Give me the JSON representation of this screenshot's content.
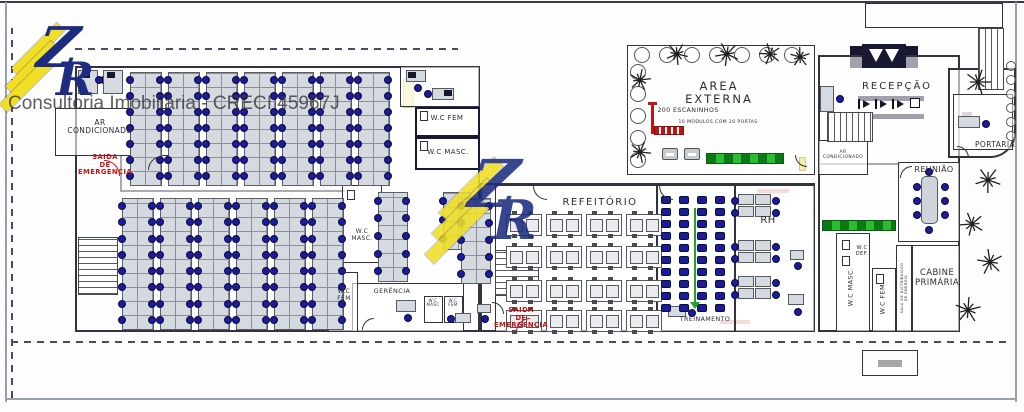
{
  "watermark": {
    "brand_text": "Consultoria Imobiliária - CRECI 45967J",
    "logo_z": "Z",
    "logo_r": "R",
    "accent_yellow": "#f0df25",
    "accent_navy": "#1d2c80"
  },
  "palette": {
    "wall": "#2e2e38",
    "desk": "#d5d9e0",
    "chair_blue": "#1b1b9e",
    "alert_red": "#c21414",
    "locker_green": "#2dbb35",
    "hatch_yellow": "#e8d22a"
  },
  "plan": {
    "labels": [
      {
        "id": "label-ar-condicionado",
        "t": "AR\nCONDICIONADO",
        "x": 100,
        "y": 119,
        "s": 7.5
      },
      {
        "id": "label-saida-emergencia-1",
        "t": "SAIDA\nDE\nEMERGENCIA",
        "x": 105,
        "y": 154,
        "s": 6.8,
        "c": "red"
      },
      {
        "id": "label-wc-fem-upper",
        "t": "W.C FEM",
        "x": 447,
        "y": 115,
        "s": 7
      },
      {
        "id": "label-wc-masc-upper",
        "t": "W.C MASC.",
        "x": 448,
        "y": 149,
        "s": 7
      },
      {
        "id": "label-area-externa",
        "t": "AREA\nEXTERNA",
        "x": 719,
        "y": 80,
        "s": 11.5,
        "ls": 2
      },
      {
        "id": "label-escaninhos",
        "t": "200 ESCANINHOS",
        "x": 688,
        "y": 107,
        "s": 6.3
      },
      {
        "id": "label-modulos",
        "t": "10 MODULOS COM 20 PORTAS",
        "x": 718,
        "y": 120,
        "s": 4.6
      },
      {
        "id": "label-recepcao",
        "t": "RECEPÇÃO",
        "x": 897,
        "y": 81,
        "s": 10,
        "ls": 2
      },
      {
        "id": "label-portaria",
        "t": "PORTARIA",
        "x": 995,
        "y": 141,
        "s": 7.5
      },
      {
        "id": "label-ar-cond-small",
        "t": "AR\nCONDICIONADO",
        "x": 843,
        "y": 151,
        "s": 4.4
      },
      {
        "id": "label-reuniao",
        "t": "REUNIÃO",
        "x": 934,
        "y": 166,
        "s": 8
      },
      {
        "id": "label-rh",
        "t": "RH",
        "x": 768,
        "y": 215,
        "s": 10
      },
      {
        "id": "label-cabine-primaria",
        "t": "CABINE\nPRIMÁRIA",
        "x": 937,
        "y": 269,
        "s": 8.5
      },
      {
        "id": "label-refeitorio",
        "t": "REFEITÓRIO",
        "x": 600,
        "y": 197,
        "s": 10,
        "ls": 1.5
      },
      {
        "id": "label-treinamento",
        "t": "TREINAMENTO",
        "x": 705,
        "y": 316,
        "s": 6.3
      },
      {
        "id": "label-gerencia",
        "t": "GERÊNCIA",
        "x": 392,
        "y": 288,
        "s": 6.5
      },
      {
        "id": "label-wc-masc-mid",
        "t": "W.C\nMASC.",
        "x": 362,
        "y": 229,
        "s": 6
      },
      {
        "id": "label-wc-fem-mid",
        "t": "W.C\nFEM",
        "x": 344,
        "y": 289,
        "s": 6
      },
      {
        "id": "label-wc-small-masc",
        "t": "W.C\nMASC",
        "x": 433,
        "y": 299,
        "s": 4
      },
      {
        "id": "label-wc-small-fem",
        "t": "W.C\nFEM",
        "x": 453,
        "y": 299,
        "s": 4
      },
      {
        "id": "label-wc-masc-right",
        "t": "W.C MASC.",
        "x": 851,
        "y": 287,
        "s": 6.5,
        "r": -90
      },
      {
        "id": "label-wc-fem-right",
        "t": "W.C FEM.",
        "x": 883,
        "y": 298,
        "s": 6.5,
        "r": -90
      },
      {
        "id": "label-wc-def",
        "t": "W.C\nDEF.",
        "x": 862,
        "y": 246,
        "s": 5.2
      },
      {
        "id": "label-sala-energia",
        "t": "SALA DE DISTRIBUIÇÃO\nDE ENERGIA",
        "x": 904,
        "y": 288,
        "s": 3.6,
        "r": -90
      },
      {
        "id": "label-saida-emergencia-2",
        "t": "SAIDA\nDE\nEMERGENCIA",
        "x": 521,
        "y": 307,
        "s": 6.8,
        "c": "red"
      }
    ],
    "rooms": [
      {
        "id": "left-block",
        "x": 75,
        "y": 66,
        "w": 405,
        "h": 266,
        "b": 2
      },
      {
        "id": "mid-block",
        "x": 480,
        "y": 183,
        "w": 335,
        "h": 149,
        "b": 2
      },
      {
        "id": "right-block",
        "x": 818,
        "y": 55,
        "w": 142,
        "h": 277,
        "b": 2
      },
      {
        "id": "area-externa",
        "x": 627,
        "y": 45,
        "w": 188,
        "h": 130,
        "b": 1.5
      },
      {
        "id": "portaria-outer",
        "x": 948,
        "y": 68,
        "w": 68,
        "h": 90,
        "b": 2,
        "rad": "0 0 26px 0"
      },
      {
        "id": "entry-canopy",
        "x": 865,
        "y": 3,
        "w": 138,
        "h": 25,
        "b": 1.5
      },
      {
        "id": "ar-condicionado",
        "x": 55,
        "y": 108,
        "w": 118,
        "h": 48,
        "b": 1.5
      },
      {
        "id": "upper-small-office",
        "x": 400,
        "y": 66,
        "w": 80,
        "h": 41,
        "b": 1.5
      },
      {
        "id": "wc-fem-upper",
        "x": 415,
        "y": 107,
        "w": 65,
        "h": 30,
        "b": 2.5,
        "c": "#181838"
      },
      {
        "id": "wc-masc-upper",
        "x": 415,
        "y": 137,
        "w": 65,
        "h": 33,
        "b": 2.5,
        "c": "#181838"
      },
      {
        "id": "wc-masc-mid",
        "x": 342,
        "y": 185,
        "w": 40,
        "h": 78,
        "b": 1.5
      },
      {
        "id": "gerencia",
        "x": 352,
        "y": 283,
        "w": 112,
        "h": 49,
        "b": 1.5
      },
      {
        "id": "wc-fem-mid",
        "x": 328,
        "y": 272,
        "w": 30,
        "h": 60,
        "b": 1.5
      },
      {
        "id": "wc-small-masc",
        "x": 424,
        "y": 296,
        "w": 19,
        "h": 27,
        "b": 1.2
      },
      {
        "id": "wc-small-fem",
        "x": 444,
        "y": 296,
        "w": 19,
        "h": 27,
        "b": 1.2
      },
      {
        "id": "refeitorio",
        "x": 495,
        "y": 185,
        "w": 162,
        "h": 147,
        "b": 1.5
      },
      {
        "id": "treinamento",
        "x": 657,
        "y": 185,
        "w": 78,
        "h": 147,
        "b": 1.5
      },
      {
        "id": "rh",
        "x": 735,
        "y": 185,
        "w": 80,
        "h": 147,
        "b": 1.5
      },
      {
        "id": "wc-masc-right",
        "x": 836,
        "y": 233,
        "w": 34,
        "h": 99,
        "b": 1.5
      },
      {
        "id": "wc-fem-right",
        "x": 872,
        "y": 268,
        "w": 24,
        "h": 64,
        "b": 1.5
      },
      {
        "id": "sala-energia",
        "x": 896,
        "y": 245,
        "w": 16,
        "h": 87,
        "b": 1.5
      },
      {
        "id": "cabine-primaria",
        "x": 912,
        "y": 245,
        "w": 48,
        "h": 87,
        "b": 1.5
      },
      {
        "id": "reuniao",
        "x": 898,
        "y": 162,
        "w": 62,
        "h": 80,
        "b": 1.5
      },
      {
        "id": "ar-cond-small",
        "x": 818,
        "y": 140,
        "w": 50,
        "h": 35,
        "b": 1.5
      },
      {
        "id": "portaria-room",
        "x": 953,
        "y": 94,
        "w": 60,
        "h": 56,
        "b": 1.5
      },
      {
        "id": "equipment-box",
        "x": 862,
        "y": 350,
        "w": 56,
        "h": 26,
        "b": 1.5
      },
      {
        "id": "wc-fixture",
        "x": 420,
        "y": 111,
        "w": 8,
        "h": 10,
        "b": 1
      },
      {
        "id": "wc-fixture",
        "x": 420,
        "y": 141,
        "w": 8,
        "h": 10,
        "b": 1
      },
      {
        "id": "wc-fixture",
        "x": 842,
        "y": 240,
        "w": 8,
        "h": 10,
        "b": 1
      },
      {
        "id": "wc-fixture",
        "x": 842,
        "y": 256,
        "w": 8,
        "h": 10,
        "b": 1
      },
      {
        "id": "wc-fixture",
        "x": 876,
        "y": 274,
        "w": 8,
        "h": 10,
        "b": 1
      },
      {
        "id": "wc-fixture",
        "x": 331,
        "y": 280,
        "w": 8,
        "h": 10,
        "b": 1
      },
      {
        "id": "wc-fixture",
        "x": 347,
        "y": 190,
        "w": 8,
        "h": 10,
        "b": 1
      }
    ],
    "walls": [
      {
        "x": 120,
        "y": 190,
        "w": 225,
        "h": 2
      },
      {
        "x": 120,
        "y": 156,
        "w": 2,
        "h": 36
      },
      {
        "x": 342,
        "y": 263,
        "w": 2,
        "h": 22
      },
      {
        "x": 818,
        "y": 163,
        "w": 82,
        "h": 2
      }
    ],
    "frame_bars": [
      {
        "x": 0,
        "y": 1,
        "w": 1024,
        "h": 2,
        "c": "#3c3c46"
      },
      {
        "x": 5,
        "y": 2,
        "w": 2,
        "h": 400,
        "c": "#9aa0a8"
      },
      {
        "x": 1015,
        "y": 2,
        "w": 2,
        "h": 400,
        "c": "#9aa0a8"
      },
      {
        "x": 5,
        "y": 398,
        "w": 1012,
        "h": 2,
        "c": "#9aa0a8"
      }
    ],
    "bars": [
      {
        "x": 858,
        "y": 96,
        "w": 66,
        "h": 5,
        "c": "#16162e"
      },
      {
        "x": 858,
        "y": 114,
        "w": 66,
        "h": 5,
        "c": "#16162e"
      },
      {
        "x": 850,
        "y": 46,
        "w": 12,
        "h": 22,
        "c": "#16162e"
      },
      {
        "x": 906,
        "y": 46,
        "w": 12,
        "h": 22,
        "c": "#16162e"
      },
      {
        "x": 757,
        "y": 189,
        "w": 32,
        "h": 4,
        "c": "#cc1414"
      },
      {
        "x": 720,
        "y": 320,
        "w": 30,
        "h": 4,
        "c": "#cc1414"
      },
      {
        "x": 403,
        "y": 78,
        "w": 11,
        "h": 30,
        "c": "#e8d22a",
        "bd": "#8a7a10"
      },
      {
        "x": 799,
        "y": 157,
        "w": 7,
        "h": 14,
        "c": "#e8d22a",
        "bd": "#8a7a10"
      },
      {
        "x": 822,
        "y": 90,
        "w": 9,
        "h": 7,
        "c": "#16162e"
      },
      {
        "x": 962,
        "y": 112,
        "w": 10,
        "h": 8,
        "c": "#16162e"
      },
      {
        "x": 480,
        "y": 306,
        "w": 8,
        "h": 7,
        "c": "#16162e"
      },
      {
        "x": 878,
        "y": 360,
        "w": 24,
        "h": 7,
        "c": "#222222"
      }
    ],
    "dashes": [
      {
        "x": 75,
        "y": 48,
        "w": 383,
        "h": 0
      },
      {
        "x": 11,
        "y": 28,
        "w": 0,
        "h": 370
      },
      {
        "x": 11,
        "y": 341,
        "w": 1001,
        "h": 0
      }
    ],
    "stairs": [
      {
        "x": 78,
        "y": 237,
        "w": 40,
        "h": 58,
        "d": "h"
      },
      {
        "x": 495,
        "y": 250,
        "w": 44,
        "h": 46,
        "d": "h"
      },
      {
        "x": 827,
        "y": 112,
        "w": 46,
        "h": 30,
        "d": "v"
      },
      {
        "x": 978,
        "y": 28,
        "w": 26,
        "h": 62,
        "d": "v"
      }
    ],
    "office_strips": [
      {
        "x": 130,
        "y": 72,
        "w": 30,
        "h": 112,
        "r": 7
      },
      {
        "x": 168,
        "y": 72,
        "w": 30,
        "h": 112,
        "r": 7
      },
      {
        "x": 206,
        "y": 72,
        "w": 30,
        "h": 112,
        "r": 7
      },
      {
        "x": 244,
        "y": 72,
        "w": 30,
        "h": 112,
        "r": 7
      },
      {
        "x": 282,
        "y": 72,
        "w": 30,
        "h": 112,
        "r": 7
      },
      {
        "x": 320,
        "y": 72,
        "w": 30,
        "h": 112,
        "r": 7
      },
      {
        "x": 358,
        "y": 72,
        "w": 30,
        "h": 112,
        "r": 7
      },
      {
        "x": 122,
        "y": 198,
        "w": 30,
        "h": 130,
        "r": 8
      },
      {
        "x": 160,
        "y": 198,
        "w": 30,
        "h": 130,
        "r": 8
      },
      {
        "x": 198,
        "y": 198,
        "w": 30,
        "h": 130,
        "r": 8
      },
      {
        "x": 236,
        "y": 198,
        "w": 30,
        "h": 130,
        "r": 8
      },
      {
        "x": 274,
        "y": 198,
        "w": 30,
        "h": 130,
        "r": 8
      },
      {
        "x": 312,
        "y": 198,
        "w": 30,
        "h": 130,
        "r": 8
      },
      {
        "x": 378,
        "y": 192,
        "w": 28,
        "h": 88,
        "r": 5
      },
      {
        "x": 443,
        "y": 192,
        "w": 26,
        "h": 56,
        "r": 3
      },
      {
        "x": 461,
        "y": 198,
        "w": 28,
        "h": 84,
        "r": 5
      }
    ],
    "desks": [
      {
        "x": 78,
        "y": 70,
        "w": 20,
        "h": 24,
        "dots": [
          [
            22,
            6
          ]
        ],
        "mon": [
          4,
          2
        ]
      },
      {
        "x": 103,
        "y": 70,
        "w": 20,
        "h": 24,
        "dots": [
          [
            -8,
            6
          ]
        ],
        "mon": [
          4,
          2
        ]
      },
      {
        "x": 406,
        "y": 70,
        "w": 20,
        "h": 12,
        "dots": [
          [
            8,
            14
          ]
        ],
        "mon": [
          2,
          2
        ]
      },
      {
        "x": 432,
        "y": 88,
        "w": 22,
        "h": 12,
        "dots": [
          [
            -8,
            2
          ]
        ],
        "mon": [
          12,
          2
        ]
      },
      {
        "x": 820,
        "y": 86,
        "w": 14,
        "h": 26,
        "dots": [
          [
            16,
            9
          ]
        ]
      },
      {
        "x": 958,
        "y": 116,
        "w": 22,
        "h": 12,
        "dots": [
          [
            24,
            4
          ]
        ]
      },
      {
        "x": 668,
        "y": 306,
        "w": 18,
        "h": 11,
        "dots": [
          [
            20,
            3
          ]
        ]
      },
      {
        "x": 790,
        "y": 250,
        "w": 14,
        "h": 10,
        "dots": [
          [
            4,
            12
          ]
        ]
      },
      {
        "x": 788,
        "y": 294,
        "w": 16,
        "h": 11,
        "dots": [
          [
            6,
            14
          ]
        ]
      },
      {
        "x": 396,
        "y": 300,
        "w": 20,
        "h": 12,
        "dots": [
          [
            8,
            14
          ]
        ]
      },
      {
        "x": 455,
        "y": 313,
        "w": 16,
        "h": 10,
        "dots": [
          [
            -8,
            2
          ]
        ]
      },
      {
        "x": 477,
        "y": 304,
        "w": 14,
        "h": 9,
        "dots": [
          [
            4,
            11
          ]
        ]
      }
    ],
    "rh_clusters": [
      {
        "x": 738,
        "y": 194
      },
      {
        "x": 738,
        "y": 240
      },
      {
        "x": 738,
        "y": 276
      }
    ],
    "dining": {
      "cols": [
        506,
        546,
        586,
        626
      ],
      "rows": [
        214,
        246,
        280,
        310
      ],
      "w": 34,
      "h": 20
    },
    "training": {
      "cols": [
        661,
        679,
        697,
        715
      ],
      "y0": 196,
      "rows": 10,
      "dy": 12,
      "w": 10,
      "h": 8
    },
    "green_line": {
      "x": 694,
      "y": 208,
      "h": 94
    },
    "reunion": {
      "table": {
        "x": 921,
        "y": 176,
        "w": 17,
        "h": 48
      },
      "chairs": [
        [
          913,
          183
        ],
        [
          913,
          197
        ],
        [
          913,
          211
        ],
        [
          941,
          183
        ],
        [
          941,
          197
        ],
        [
          941,
          211
        ],
        [
          925,
          168
        ],
        [
          925,
          226
        ]
      ]
    },
    "turnstiles": {
      "x": 858,
      "y": 99,
      "n": 3
    },
    "entrance": {
      "x": 862,
      "y": 44,
      "w": 44,
      "h": 24
    },
    "escaninhos": {
      "x": 648,
      "y": 102
    },
    "green_strips": [
      {
        "x": 706,
        "y": 153,
        "w": 78,
        "h": 11
      },
      {
        "x": 822,
        "y": 220,
        "w": 74,
        "h": 11
      }
    ],
    "benches": [
      {
        "x": 662,
        "y": 148
      },
      {
        "x": 684,
        "y": 148
      }
    ],
    "trees": [
      [
        978,
        82,
        13
      ],
      [
        677,
        54,
        11
      ],
      [
        727,
        54,
        12
      ],
      [
        770,
        54,
        11
      ],
      [
        800,
        57,
        10
      ],
      [
        640,
        80,
        11
      ],
      [
        640,
        152,
        11
      ],
      [
        988,
        180,
        13
      ],
      [
        972,
        224,
        12
      ],
      [
        990,
        262,
        13
      ],
      [
        968,
        310,
        13
      ]
    ],
    "shrubs": [
      [
        642,
        55,
        8
      ],
      [
        667,
        55,
        8
      ],
      [
        692,
        55,
        8
      ],
      [
        717,
        55,
        8
      ],
      [
        742,
        55,
        8
      ],
      [
        767,
        55,
        8
      ],
      [
        792,
        55,
        8
      ],
      [
        638,
        72,
        8
      ],
      [
        638,
        94,
        8
      ],
      [
        638,
        116,
        8
      ],
      [
        638,
        138,
        8
      ],
      [
        638,
        160,
        8
      ],
      [
        1011,
        66,
        5
      ],
      [
        1011,
        80,
        5
      ],
      [
        1011,
        94,
        5
      ],
      [
        1011,
        108,
        5
      ],
      [
        1011,
        122,
        5
      ],
      [
        1011,
        136,
        5
      ]
    ],
    "arcs": [
      [
        533,
        186,
        14,
        "bl",
        "#333"
      ],
      [
        659,
        186,
        14,
        "bl",
        "#333"
      ],
      [
        900,
        166,
        12,
        "tl",
        "#333"
      ],
      [
        957,
        146,
        12,
        "tr",
        "#333"
      ],
      [
        148,
        156,
        14,
        "tl",
        "#333"
      ],
      [
        492,
        302,
        12,
        "tr",
        "#333"
      ],
      [
        795,
        155,
        12,
        "bl",
        "#333"
      ],
      [
        362,
        318,
        12,
        "tl",
        "#333"
      ],
      [
        104,
        160,
        16,
        "tr",
        "#cc1414"
      ],
      [
        516,
        318,
        14,
        "tl",
        "#cc1414"
      ]
    ]
  }
}
